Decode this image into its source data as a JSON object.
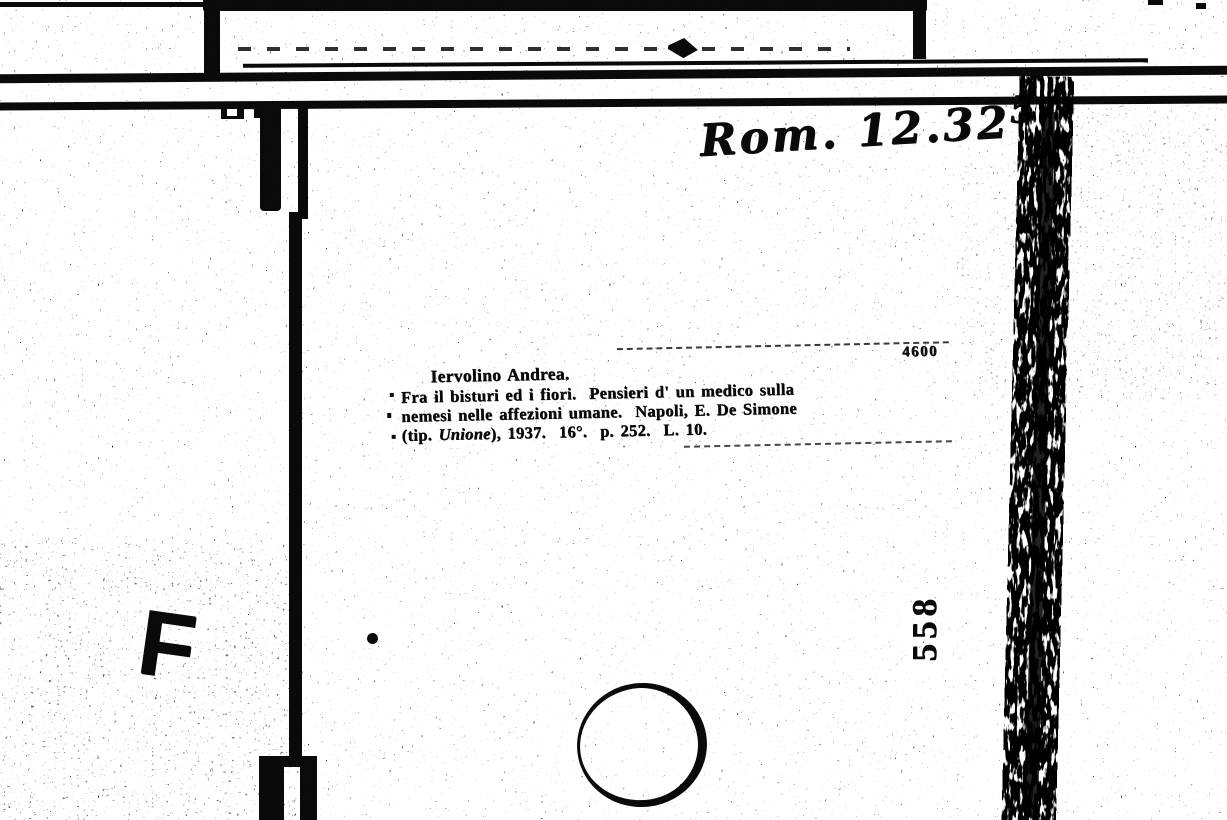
{
  "scan": {
    "shelfmark_handwritten": {
      "prefix": "Rom. 12.32",
      "raised_digit": "5"
    },
    "catalog_slip": {
      "entry_number": "4600",
      "author": "Iervolino Andrea.",
      "title_line_1": "Fra il bisturi ed i fiori.  Pensieri d' un medico sulla",
      "title_line_2": "nemesi nelle affezioni umane.  Napoli, E. De Simone",
      "imprint_pre": "(tip. ",
      "imprint_publisher": "Unione",
      "imprint_post": "), 1937.  16°.  p. 252.  L. 10."
    },
    "stamps": {
      "letter": "F",
      "vertical_number": "558"
    },
    "colors": {
      "ink": "#0a0a0a",
      "paper": "#ffffff"
    }
  }
}
